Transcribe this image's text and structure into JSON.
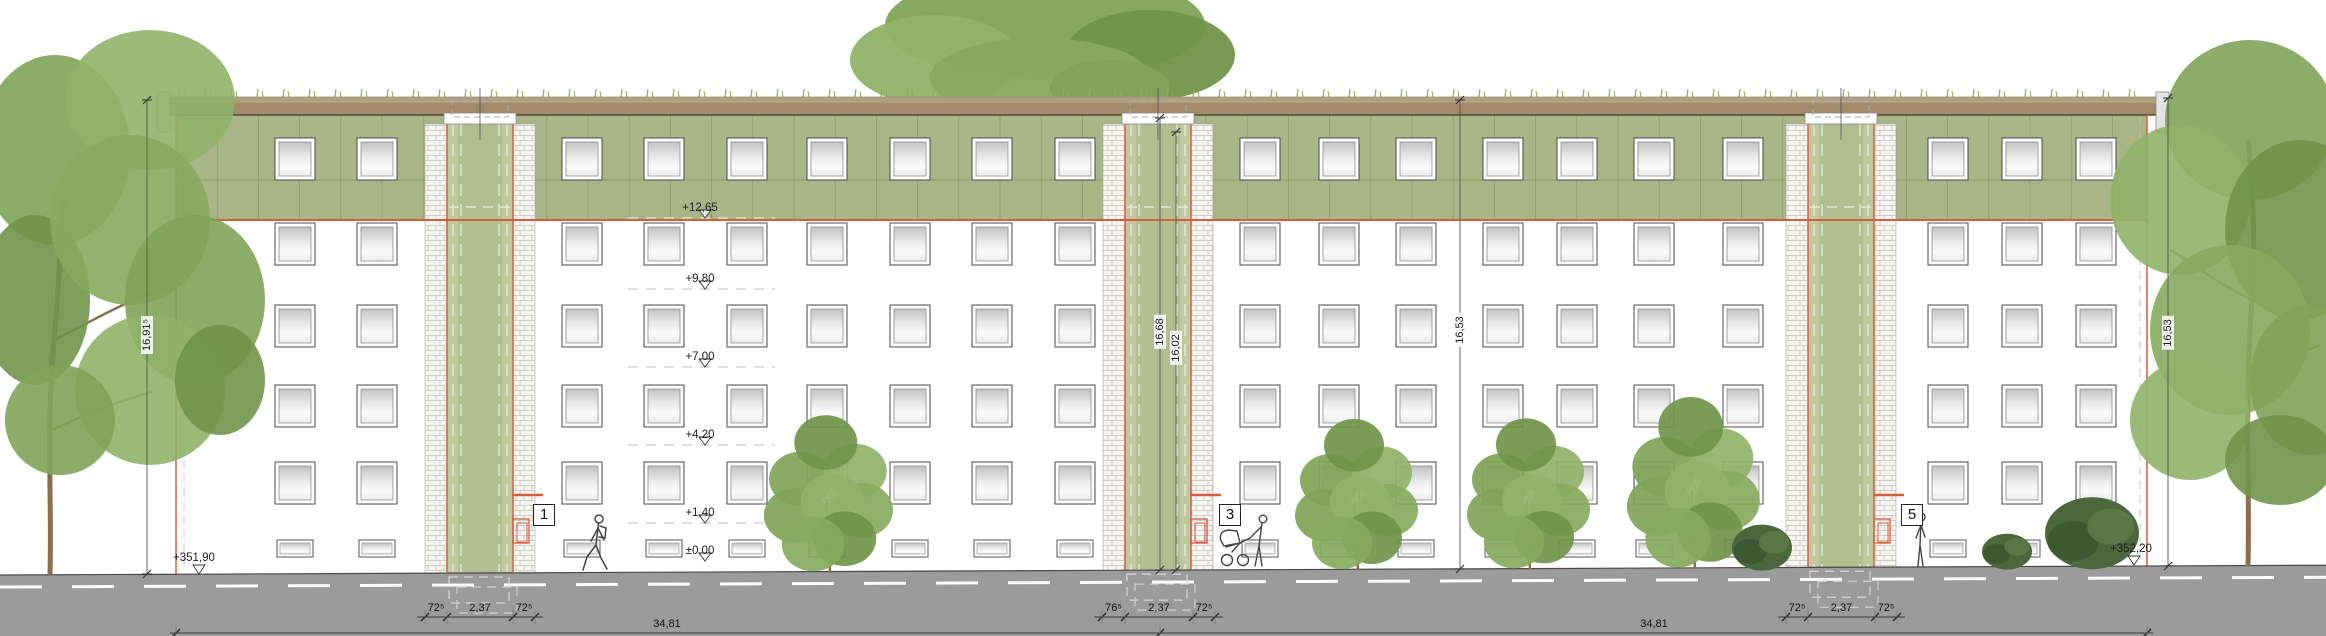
{
  "annotations": {
    "level_x": 700,
    "levels": [
      {
        "label": "+12,65",
        "y": 218,
        "on_green": true
      },
      {
        "label": "+9,80",
        "y": 289
      },
      {
        "label": "+7,00",
        "y": 367
      },
      {
        "label": "+4,20",
        "y": 445
      },
      {
        "label": "+1,40",
        "y": 523
      },
      {
        "label": "±0,00",
        "y": 561,
        "no_dash": true
      }
    ],
    "ground_markers": [
      {
        "label": "+351,90",
        "x": 194,
        "y": 563,
        "tri_x": 199
      },
      {
        "label": "+352,20",
        "x": 2131,
        "y": 554,
        "tri_x": 2134
      }
    ],
    "vertical_dims": [
      {
        "label": "16,91⁵",
        "x": 147,
        "y1": 100,
        "y2": 574,
        "ty": 335
      },
      {
        "label": "16,68",
        "x": 1160,
        "y1": 118,
        "y2": 570,
        "ty": 332
      },
      {
        "label": "16,02",
        "x": 1176,
        "y1": 132,
        "y2": 570,
        "ty": 348
      },
      {
        "label": "16,53",
        "x": 1460,
        "y1": 100,
        "y2": 569,
        "ty": 330
      },
      {
        "label": "16,53",
        "x": 2168,
        "y1": 98,
        "y2": 566,
        "ty": 333
      }
    ],
    "tower_width_dims": [
      {
        "labels": [
          "72⁵",
          "2,37",
          "72⁵"
        ],
        "ticks": [
          425,
          447,
          513,
          535
        ]
      },
      {
        "labels": [
          "76⁵",
          "2,37",
          "72⁵"
        ],
        "ticks": [
          1102,
          1125,
          1193,
          1215
        ]
      },
      {
        "labels": [
          "72⁵",
          "2,37",
          "72⁵"
        ],
        "ticks": [
          1786,
          1808,
          1875,
          1897
        ]
      }
    ],
    "width_dim_y": 617,
    "overall_dims": {
      "y": 633,
      "ticks": [
        176,
        1160,
        2147
      ],
      "labels": [
        {
          "label": "34,81",
          "x": 667
        },
        {
          "label": "34,81",
          "x": 1654
        }
      ]
    },
    "position_markers": [
      {
        "label": "1",
        "x": 533,
        "y": 504
      },
      {
        "label": "3",
        "x": 1219,
        "y": 504
      },
      {
        "label": "5",
        "x": 1901,
        "y": 504
      }
    ]
  },
  "colors": {
    "facade_green": "#a9b586",
    "tower_green": "#b2bd90",
    "tower_green_light": "#c2cba2",
    "panel_joint": "#76874f",
    "roof_brown": "#a28a6b",
    "roof_brown_light": "#b59e7e",
    "roof_brown_dark": "#57493a",
    "accent_red": "#d85c40",
    "road_gray": "#9b9b9b",
    "grass_green": "#8cb055",
    "tree_green_1": "#7fa457",
    "tree_green_2": "#8fb368",
    "tree_green_3": "#6f9549",
    "tree_green_4": "#86ab5e",
    "dark_bush": "#4a683c",
    "trunk_brown": "#8a6f4f",
    "figure_line": "#444444"
  },
  "layout": {
    "canvas": {
      "w": 2326,
      "h": 636
    },
    "ground": {
      "y0": 575,
      "slope": 0.0042
    },
    "building": {
      "x1": 176,
      "x2": 2147,
      "top": 115,
      "green_bottom": 220,
      "joint_y": 180,
      "panel_w": 41.2
    },
    "roof": {
      "x1": 165,
      "x2": 2160,
      "y1": 97,
      "y2": 115
    },
    "towers": [
      425,
      1103,
      1786
    ],
    "tower": {
      "w": 110,
      "brick_w": 22,
      "body_top": 124
    },
    "window": {
      "w": 40,
      "h": 42,
      "rows": [
        138,
        223,
        305,
        385,
        462
      ],
      "basement_y": 540,
      "basement_w": 36,
      "basement_h": 17
    },
    "sections": {
      "A": [
        275,
        357
      ],
      "B": [
        562,
        644,
        727,
        807,
        890,
        972,
        1055
      ],
      "C": [
        1240,
        1319,
        1396,
        1483,
        1557,
        1634,
        1723
      ],
      "D": [
        1928,
        2002,
        2076
      ]
    },
    "front_trees": [
      {
        "cx": 830,
        "w": 105,
        "h": 130
      },
      {
        "cx": 1358,
        "w": 100,
        "h": 125
      },
      {
        "cx": 1530,
        "w": 100,
        "h": 125
      },
      {
        "cx": 1695,
        "w": 108,
        "h": 142
      }
    ],
    "bushes": [
      {
        "cx": 1762,
        "rx": 30,
        "ry": 23
      },
      {
        "cx": 2007,
        "rx": 25,
        "ry": 18
      },
      {
        "cx": 2092,
        "rx": 47,
        "ry": 36
      }
    ]
  }
}
